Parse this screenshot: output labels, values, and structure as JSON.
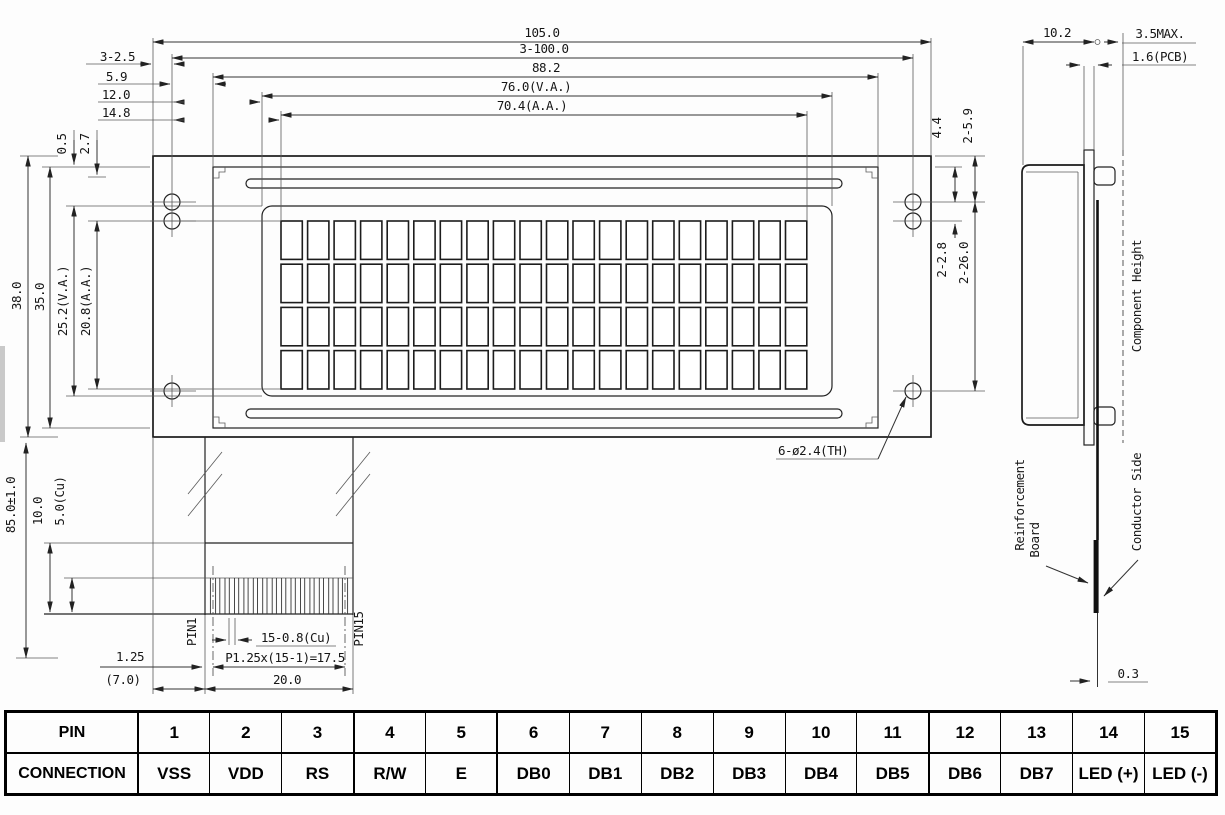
{
  "front": {
    "dim_105": "105.0",
    "dim_3_100": "3-100.0",
    "dim_88": "88.2",
    "dim_76": "76.0(V.A.)",
    "dim_70": "70.4(A.A.)",
    "dim_3_25": "3-2.5",
    "dim_59": "5.9",
    "dim_12": "12.0",
    "dim_148": "14.8",
    "dim_05": "0.5",
    "dim_27": "2.7",
    "dim_38": "38.0",
    "dim_35": "35.0",
    "dim_252": "25.2(V.A.)",
    "dim_208": "20.8(A.A.)",
    "dim_44": "4.4",
    "dim_2_59": "2-5.9",
    "dim_2_28": "2-2.8",
    "dim_2_26": "2-26.0",
    "hole_callout": "6-ø2.4(TH)",
    "display": {
      "columns": 20,
      "rows": 4
    }
  },
  "tail": {
    "dim_85": "85.0±1.0",
    "dim_10": "10.0",
    "dim_5cu": "5.0(Cu)",
    "pin1": "PIN1",
    "pin15": "PIN15",
    "dim_contact": "15-0.8(Cu)",
    "dim_pitch": "P1.25x(15-1)=17.5",
    "dim_125": "1.25",
    "dim_70": "(7.0)",
    "dim_20": "20.0",
    "contact_count": 15
  },
  "side": {
    "dim_102": "10.2",
    "dim_35max": "3.5MAX.",
    "dim_16": "1.6(PCB)",
    "dim_03": "0.3",
    "component_height": "Component Height",
    "reinforcement_line1": "Reinforcement",
    "reinforcement_line2": "Board",
    "conductor_side": "Conductor Side"
  },
  "pin_table": {
    "header_row": "PIN",
    "header_conn": "CONNECTION",
    "pins": [
      {
        "n": "1",
        "c": "VSS"
      },
      {
        "n": "2",
        "c": "VDD"
      },
      {
        "n": "3",
        "c": "RS"
      },
      {
        "n": "4",
        "c": "R/W"
      },
      {
        "n": "5",
        "c": "E"
      },
      {
        "n": "6",
        "c": "DB0"
      },
      {
        "n": "7",
        "c": "DB1"
      },
      {
        "n": "8",
        "c": "DB2"
      },
      {
        "n": "9",
        "c": "DB3"
      },
      {
        "n": "10",
        "c": "DB4"
      },
      {
        "n": "11",
        "c": "DB5"
      },
      {
        "n": "12",
        "c": "DB6"
      },
      {
        "n": "13",
        "c": "DB7"
      },
      {
        "n": "14",
        "c": "LED (+)"
      },
      {
        "n": "15",
        "c": "LED (-)"
      }
    ]
  }
}
